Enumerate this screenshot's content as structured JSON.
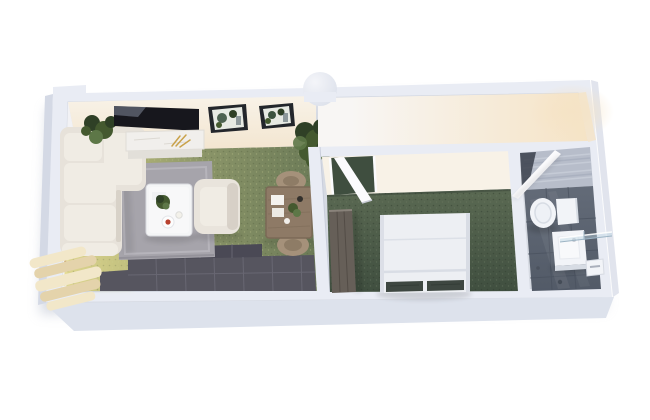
{
  "meta": {
    "description": "3D isometric top-down rendering of a studio apartment floor plan on a white background",
    "width": 650,
    "height": 420
  },
  "scene": {
    "type": "3d-floor-plan-render",
    "rooms": [
      {
        "id": "living-dining-room",
        "floor": "olive green carpet, sunlit near window, gray area rug, dark slate tile strip along bottom wall",
        "contents": [
          "L-shaped cream sectional sofa",
          "white coffee table with plant, plates and cup",
          "cream armchair",
          "wall-mounted black TV",
          "white marble media console with gold decor",
          "two dark-framed botanical prints",
          "potted green plants",
          "square wooden dining table with tableware",
          "two round rattan chairs",
          "window with stacked cream curtains"
        ]
      },
      {
        "id": "entry-hallway",
        "floor": "white glossy floor with warm daylight glow from the right end"
      },
      {
        "id": "bedroom",
        "floor": "dark green carpet",
        "contents": [
          "double bed with white duvet and two dark pillows",
          "tall dark-wood wardrobe along left wall",
          "white door swung open at top-left"
        ]
      },
      {
        "id": "bathroom",
        "floor": "dark slate tiles",
        "contents": [
          "white toilet",
          "white vanity sink",
          "glass shower screen",
          "toilet paper holder on right wall",
          "textured concrete accent wall",
          "white door swung open from hallway"
        ]
      }
    ],
    "structure": [
      "thick white exterior walls seen from above",
      "round column bump on the top wall",
      "interior partition walls with open doorways"
    ]
  },
  "colors": {
    "background": "#ffffff",
    "building_shadow": "#bcc2d0",
    "wall_top": "#e9ecf4",
    "wall_outer_face": "#dde2ec",
    "wall_outer_face_dark": "#d4d9e5",
    "wall_inner_white": "#f2f2f5",
    "wall_warm_light": "#f8f2e7",
    "wall_warm_deep": "#f3e5cf",
    "column_light": "#f4f5f9",
    "column_dark": "#d9dee9",
    "living_carpet_sunlit": "#d8d28d",
    "living_carpet_light": "#b3b578",
    "living_carpet": "#8a9468",
    "living_carpet_dark": "#6b7a57",
    "carpet_speckle_dark": "#55613f",
    "carpet_speckle_light": "#c3c98f",
    "sun_pool": "#e3da8f",
    "window_glow": "#f6ecd0",
    "window_frame": "#c9a86e",
    "curtain": "#f2e7c9",
    "curtain_shade": "#e4d3ab",
    "rug": "#a6a4ab",
    "rug_light": "#b6b4bb",
    "rug_shadow": "#908e96",
    "dark_tile": "#56555f",
    "dark_tile_deep": "#4a4955",
    "dark_tile_grout": "#6a6975",
    "sofa": "#e7e2da",
    "sofa_light": "#f0ece4",
    "sofa_shadow": "#cfc8bd",
    "coffee_table": "#f4f5f6",
    "plate_red": "#b8412f",
    "armchair": "#e9e4dc",
    "tv_screen": "#17171d",
    "tv_reflection": "#8b93a6",
    "console_marble": "#f1efec",
    "console_shelf": "#e2dfd9",
    "decor_gold": "#c9a24a",
    "art_frame": "#23262b",
    "art_paper": "#e7eae3",
    "art_green": "#3c5340",
    "plant_dark": "#2f4026",
    "plant_mid": "#44592f",
    "plant_light": "#5d7747",
    "dining_wood": "#8e7a66",
    "dining_wood_dark": "#7b6956",
    "chair_rattan": "#a5917a",
    "chair_rattan_dark": "#7e6e59",
    "hall_floor": "#f8f6f4",
    "hall_floor_warm": "#f5e3c5",
    "bedroom_carpet": "#5a6952",
    "bedroom_carpet_dark": "#3f4e3f",
    "bedroom_speckle": "#2f3b2e",
    "bedroom_speckle_light": "#6e7d65",
    "wardrobe": "#665f58",
    "wardrobe_dark": "#514b45",
    "bed_duvet": "#edeff3",
    "bed_fold": "#d9dde5",
    "bed_pillow": "#3e4741",
    "door_white": "#fbfbfd",
    "bath_floor": "#636b78",
    "bath_floor_dark": "#525a67",
    "bath_accent_wall": "#b7bdca",
    "bath_accent_light": "#ccd1dc",
    "porcelain": "#f2f4f8",
    "porcelain_shadow": "#d7dce4",
    "glass_tint": "#bcd4e2",
    "glass_edge": "#9db4c4"
  }
}
